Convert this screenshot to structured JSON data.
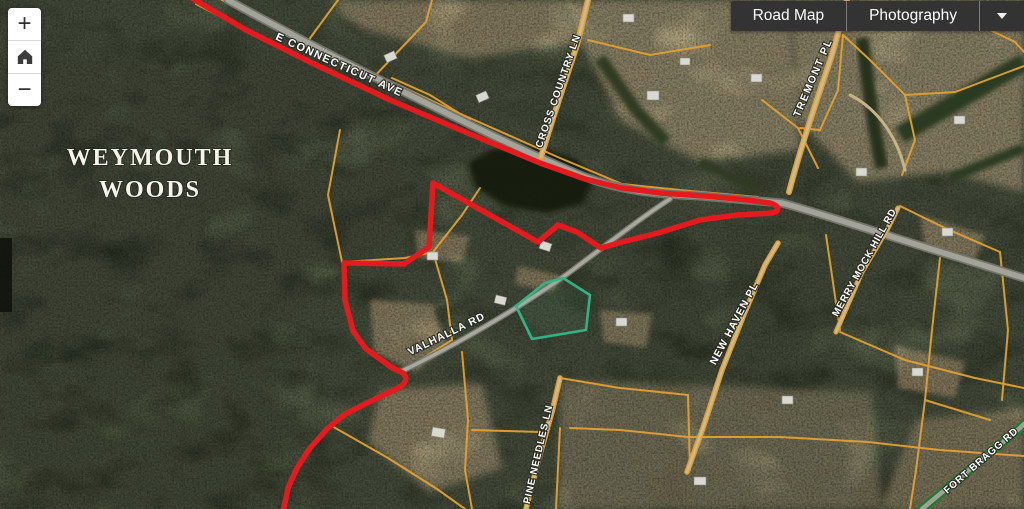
{
  "toolbar": {
    "road_map_label": "Road Map",
    "photography_label": "Photography",
    "dropdown_icon": "caret-down"
  },
  "zoom_controls": {
    "zoom_in_label": "+",
    "zoom_out_label": "−",
    "home_icon": "home"
  },
  "map": {
    "place_label": {
      "line1": "WEYMOUTH",
      "line2": "WOODS"
    },
    "road_labels": [
      {
        "name": "e-connecticut-ave",
        "text": "E CONNECTICUT AVE"
      },
      {
        "name": "cross-country-ln",
        "text": "CROSS COUNTRY LN"
      },
      {
        "name": "tremont-pl",
        "text": "TREMONT PL"
      },
      {
        "name": "merry-mock-hill-rd",
        "text": "MERRY MOCK HILL RD"
      },
      {
        "name": "new-haven-pl",
        "text": "NEW HAVEN PL"
      },
      {
        "name": "valhalla-rd",
        "text": "VALHALLA RD"
      },
      {
        "name": "pine-needles-ln",
        "text": "PINE NEEDLES LN"
      },
      {
        "name": "fort-bragg-rd",
        "text": "FORT BRAGG RD"
      }
    ],
    "colors": {
      "parcel_line": "#E2A033",
      "highlight_boundary": "#E31B1E",
      "selected_parcel": "#35B285",
      "route_green": "#1E7C30",
      "road_fill": "#A3A39A",
      "toolbar_bg": "#333333",
      "toolbar_text": "#FFFFFF"
    }
  }
}
